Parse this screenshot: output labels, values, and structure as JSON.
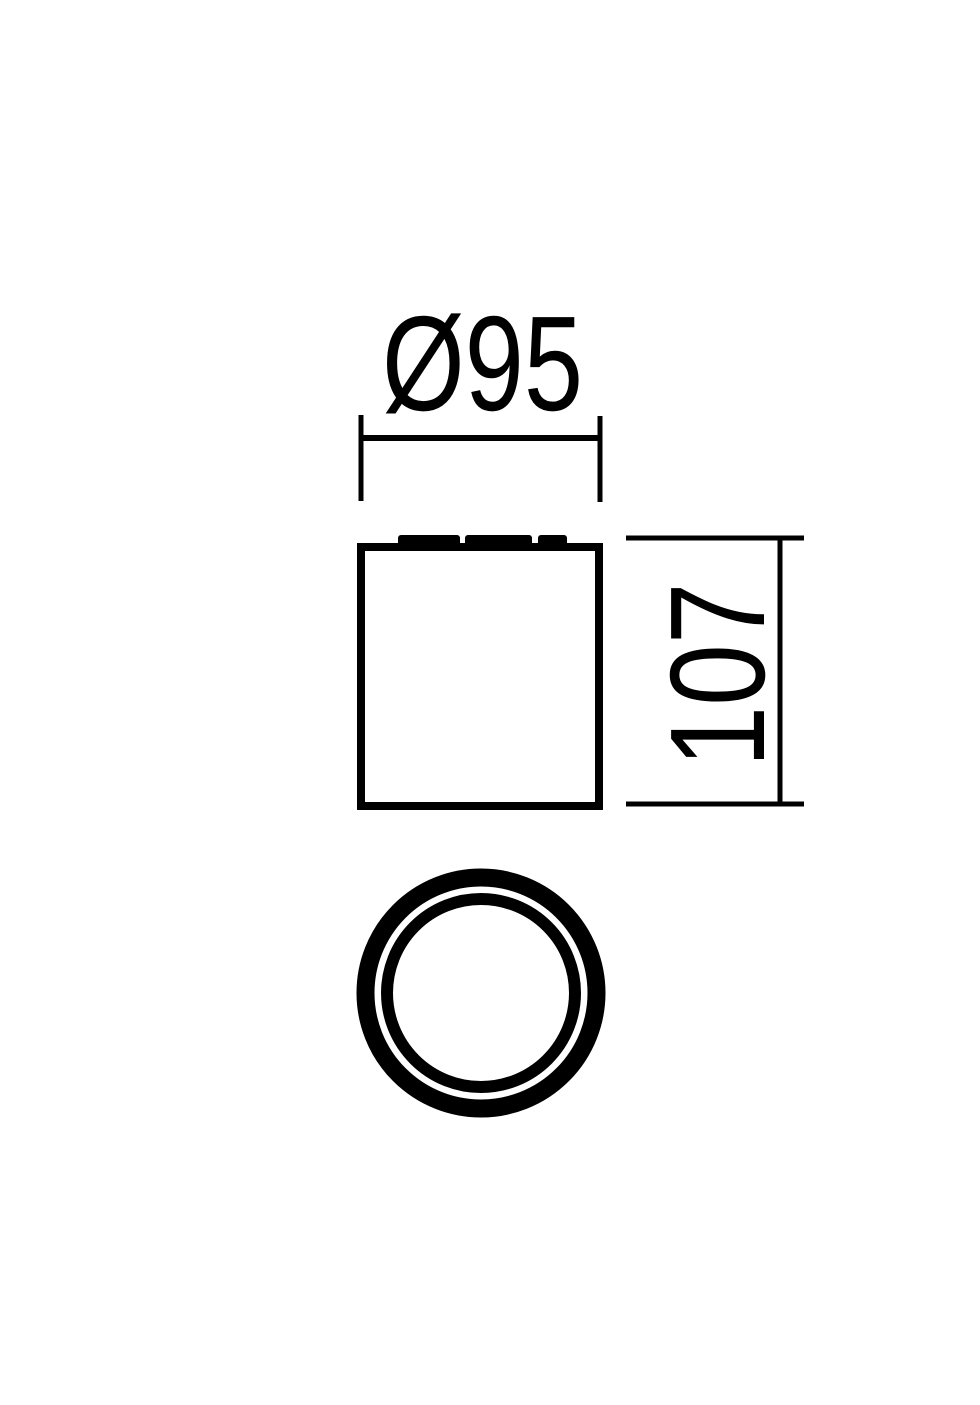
{
  "diagram": {
    "kind": "technical-dimension-drawing",
    "background_color": "#ffffff",
    "line_color": "#000000",
    "labels": {
      "diameter": "Ø95",
      "height": "107"
    }
  }
}
